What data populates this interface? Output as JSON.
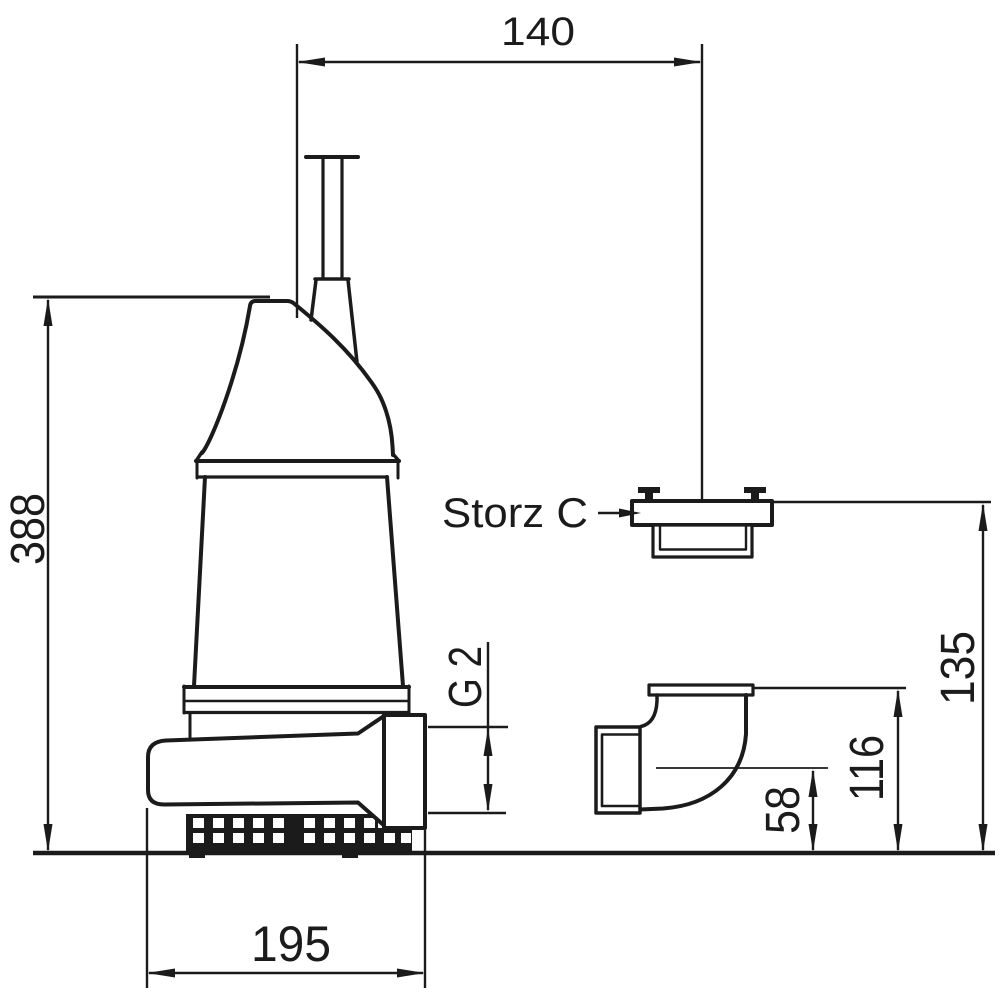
{
  "drawing": {
    "kind": "technical-dimension-drawing",
    "subject": "submersible drainage pump side view with Storz hose coupling and discharge elbow",
    "colors": {
      "line": "#1b1b1b",
      "background": "#ffffff"
    },
    "labels": {
      "coupling": "Storz C",
      "thread": "G 2"
    },
    "dimensions": {
      "top_width": "140",
      "overall_height": "388",
      "base_width": "195",
      "coupling_height": "135",
      "elbow_flange_height": "116",
      "outlet_axis_height": "58"
    }
  }
}
